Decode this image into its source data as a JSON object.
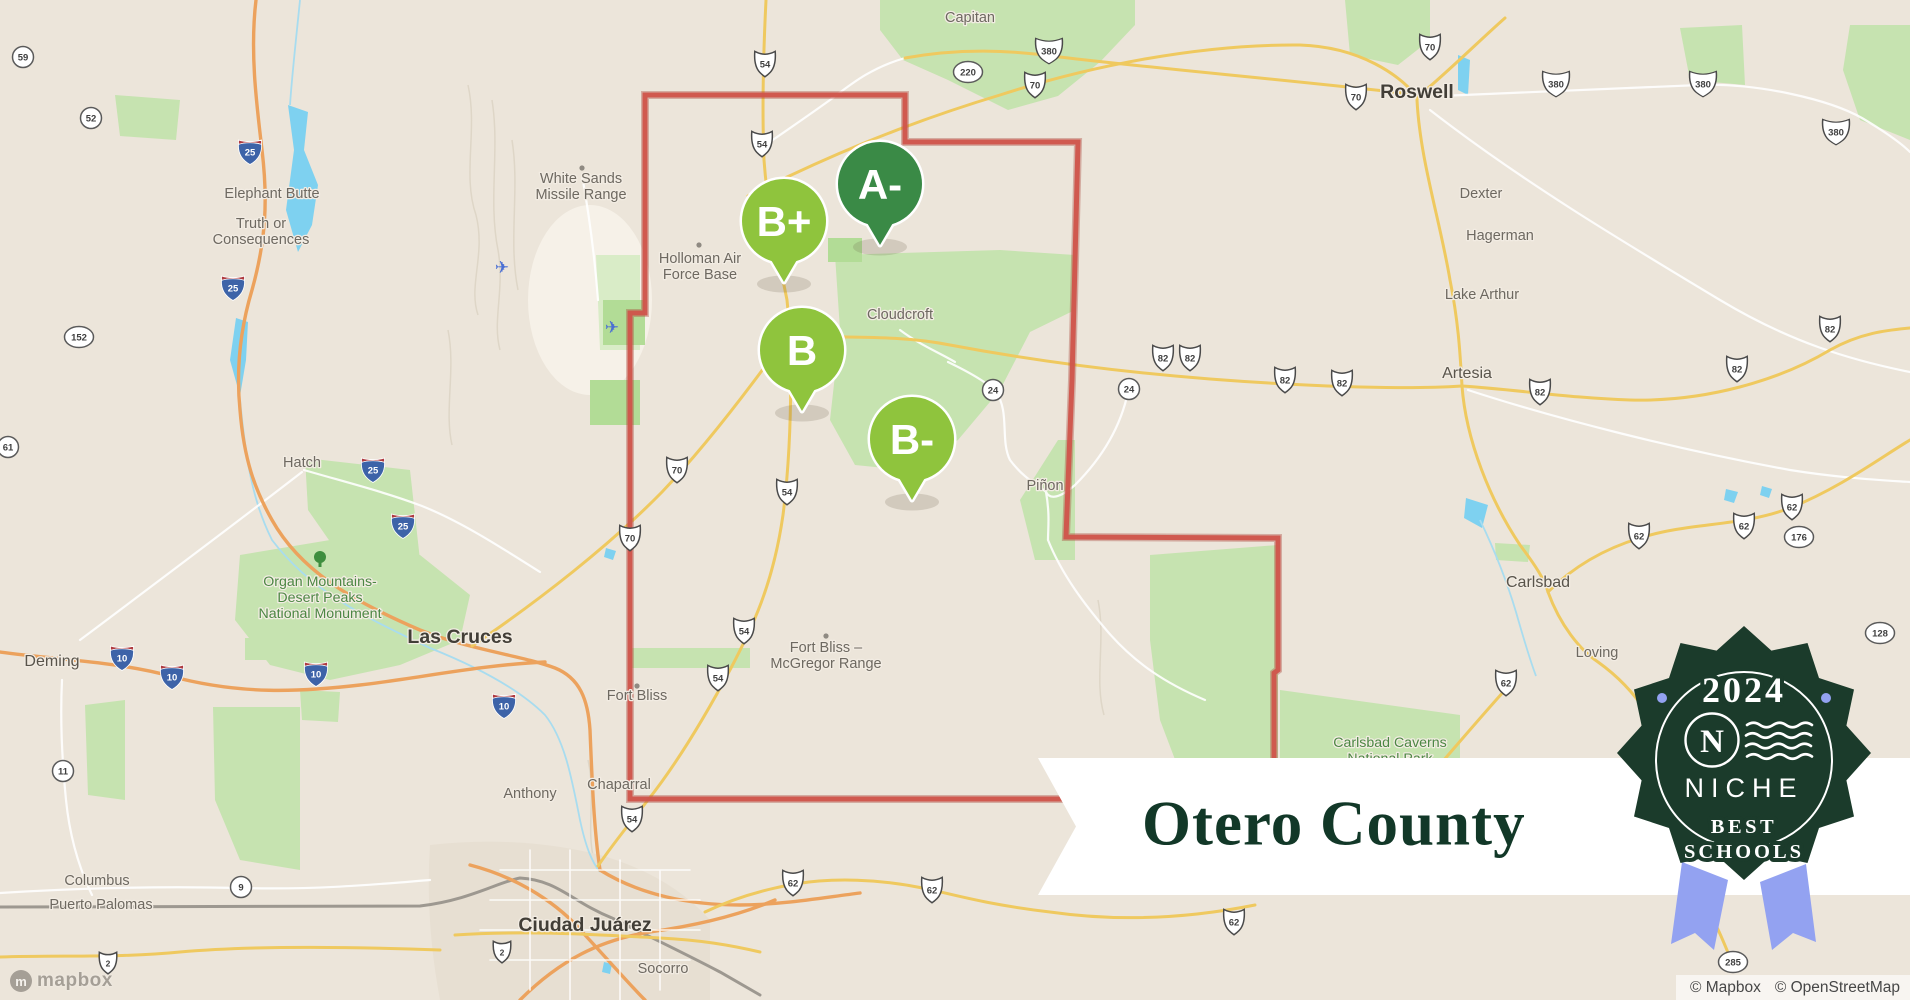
{
  "banner": {
    "title": "Otero County"
  },
  "badge": {
    "year": "2024",
    "logo_letter": "N",
    "brand": "NICHE",
    "tagline_line1": "BEST",
    "tagline_line2": "SCHOOLS",
    "bg_color": "#1b3b2b",
    "ribbon_color": "#93a2f1"
  },
  "attribution": {
    "mapbox": "© Mapbox",
    "osm": "© OpenStreetMap"
  },
  "logo": {
    "text": "mapbox",
    "icon_letter": "m"
  },
  "colors": {
    "land": "#ede6dc",
    "forest": "#c6e3b0",
    "water": "#7ed1f0",
    "county_line": "#d0544b",
    "road_yellow": "#efc95f",
    "road_orange": "#eca25d",
    "marker_a": "#3a8a46",
    "marker_b": "#8fc43d"
  },
  "map": {
    "markers": [
      {
        "grade": "A-",
        "x": 880,
        "y": 184,
        "color": "#3a8a46"
      },
      {
        "grade": "B+",
        "x": 784,
        "y": 221,
        "color": "#8fc43d"
      },
      {
        "grade": "B",
        "x": 802,
        "y": 350,
        "color": "#8fc43d"
      },
      {
        "grade": "B-",
        "x": 912,
        "y": 439,
        "color": "#8fc43d"
      }
    ],
    "towns": [
      {
        "x": 970,
        "y": 22,
        "cls": "",
        "lines": [
          "Capitan"
        ]
      },
      {
        "x": 1417,
        "y": 98,
        "cls": "lg",
        "lines": [
          "Roswell"
        ]
      },
      {
        "x": 272,
        "y": 198,
        "cls": "",
        "lines": [
          "Elephant Butte"
        ]
      },
      {
        "x": 261,
        "y": 228,
        "cls": "",
        "lines": [
          "Truth or",
          "Consequences"
        ]
      },
      {
        "x": 1481,
        "y": 198,
        "cls": "",
        "lines": [
          "Dexter"
        ]
      },
      {
        "x": 1500,
        "y": 240,
        "cls": "",
        "lines": [
          "Hagerman"
        ]
      },
      {
        "x": 1482,
        "y": 299,
        "cls": "",
        "lines": [
          "Lake Arthur"
        ]
      },
      {
        "x": 1467,
        "y": 378,
        "cls": "md",
        "lines": [
          "Artesia"
        ]
      },
      {
        "x": 581,
        "y": 183,
        "cls": "",
        "lines": [
          "White Sands",
          "Missile Range"
        ]
      },
      {
        "x": 700,
        "y": 263,
        "cls": "",
        "lines": [
          "Holloman Air",
          "Force Base"
        ]
      },
      {
        "x": 900,
        "y": 319,
        "cls": "",
        "lines": [
          "Cloudcroft"
        ]
      },
      {
        "x": 302,
        "y": 467,
        "cls": "",
        "lines": [
          "Hatch"
        ]
      },
      {
        "x": 1045,
        "y": 490,
        "cls": "",
        "lines": [
          "Piñon"
        ]
      },
      {
        "x": 460,
        "y": 643,
        "cls": "lg",
        "lines": [
          "Las Cruces"
        ]
      },
      {
        "x": 52,
        "y": 666,
        "cls": "md",
        "lines": [
          "Deming"
        ]
      },
      {
        "x": 826,
        "y": 652,
        "cls": "",
        "lines": [
          "Fort Bliss –",
          "McGregor Range"
        ]
      },
      {
        "x": 637,
        "y": 700,
        "cls": "",
        "lines": [
          "Fort Bliss"
        ]
      },
      {
        "x": 1538,
        "y": 587,
        "cls": "md",
        "lines": [
          "Carlsbad"
        ]
      },
      {
        "x": 1597,
        "y": 657,
        "cls": "",
        "lines": [
          "Loving"
        ]
      },
      {
        "x": 619,
        "y": 789,
        "cls": "",
        "lines": [
          "Chaparral"
        ]
      },
      {
        "x": 530,
        "y": 798,
        "cls": "",
        "lines": [
          "Anthony"
        ]
      },
      {
        "x": 97,
        "y": 885,
        "cls": "",
        "lines": [
          "Columbus"
        ]
      },
      {
        "x": 101,
        "y": 909,
        "cls": "",
        "lines": [
          "Puerto Palomas"
        ]
      },
      {
        "x": 585,
        "y": 931,
        "cls": "lg",
        "lines": [
          "Ciudad Juárez"
        ]
      },
      {
        "x": 663,
        "y": 973,
        "cls": "",
        "lines": [
          "Socorro"
        ]
      },
      {
        "x": 320,
        "y": 586,
        "cls": "area",
        "lines": [
          "Organ Mountains-",
          "Desert Peaks",
          "National Monument"
        ]
      },
      {
        "x": 1390,
        "y": 747,
        "cls": "area",
        "lines": [
          "Carlsbad Caverns",
          "National Park"
        ]
      }
    ],
    "shields": [
      {
        "num": "54",
        "type": "us",
        "x": 765,
        "y": 64
      },
      {
        "num": "54",
        "type": "us",
        "x": 762,
        "y": 144
      },
      {
        "num": "380",
        "type": "us3",
        "x": 1049,
        "y": 51
      },
      {
        "num": "220",
        "type": "o",
        "x": 968,
        "y": 72
      },
      {
        "num": "70",
        "type": "us",
        "x": 1035,
        "y": 85
      },
      {
        "num": "70",
        "type": "us",
        "x": 1430,
        "y": 47
      },
      {
        "num": "70",
        "type": "us",
        "x": 1356,
        "y": 97
      },
      {
        "num": "380",
        "type": "us3",
        "x": 1556,
        "y": 84
      },
      {
        "num": "380",
        "type": "us3",
        "x": 1703,
        "y": 84
      },
      {
        "num": "380",
        "type": "us3",
        "x": 1836,
        "y": 132
      },
      {
        "num": "59",
        "type": "c",
        "x": 23,
        "y": 57
      },
      {
        "num": "52",
        "type": "c",
        "x": 91,
        "y": 118
      },
      {
        "num": "25",
        "type": "i",
        "x": 250,
        "y": 152
      },
      {
        "num": "25",
        "type": "i",
        "x": 233,
        "y": 288
      },
      {
        "num": "152",
        "type": "o",
        "x": 79,
        "y": 337
      },
      {
        "num": "61",
        "type": "c",
        "x": 8,
        "y": 447
      },
      {
        "num": "25",
        "type": "i",
        "x": 373,
        "y": 470
      },
      {
        "num": "25",
        "type": "i",
        "x": 403,
        "y": 526
      },
      {
        "num": "70",
        "type": "us",
        "x": 677,
        "y": 470
      },
      {
        "num": "70",
        "type": "us",
        "x": 630,
        "y": 538
      },
      {
        "num": "54",
        "type": "us",
        "x": 787,
        "y": 492
      },
      {
        "num": "54",
        "type": "us",
        "x": 744,
        "y": 631
      },
      {
        "num": "54",
        "type": "us",
        "x": 718,
        "y": 678
      },
      {
        "num": "54",
        "type": "us",
        "x": 632,
        "y": 819
      },
      {
        "num": "24",
        "type": "c",
        "x": 993,
        "y": 390
      },
      {
        "num": "24",
        "type": "c",
        "x": 1129,
        "y": 389
      },
      {
        "num": "82",
        "type": "us",
        "x": 1163,
        "y": 358
      },
      {
        "num": "82",
        "type": "us",
        "x": 1190,
        "y": 358
      },
      {
        "num": "82",
        "type": "us",
        "x": 1285,
        "y": 380
      },
      {
        "num": "82",
        "type": "us",
        "x": 1342,
        "y": 383
      },
      {
        "num": "82",
        "type": "us",
        "x": 1540,
        "y": 392
      },
      {
        "num": "82",
        "type": "us",
        "x": 1737,
        "y": 369
      },
      {
        "num": "82",
        "type": "us",
        "x": 1830,
        "y": 329
      },
      {
        "num": "10",
        "type": "i",
        "x": 122,
        "y": 658
      },
      {
        "num": "10",
        "type": "i",
        "x": 172,
        "y": 677
      },
      {
        "num": "10",
        "type": "i",
        "x": 316,
        "y": 674
      },
      {
        "num": "10",
        "type": "i",
        "x": 504,
        "y": 706
      },
      {
        "num": "62",
        "type": "us",
        "x": 1639,
        "y": 536
      },
      {
        "num": "62",
        "type": "us",
        "x": 1744,
        "y": 526
      },
      {
        "num": "62",
        "type": "us",
        "x": 1792,
        "y": 507
      },
      {
        "num": "176",
        "type": "o",
        "x": 1799,
        "y": 537
      },
      {
        "num": "128",
        "type": "o",
        "x": 1880,
        "y": 633
      },
      {
        "num": "62",
        "type": "us",
        "x": 1506,
        "y": 683
      },
      {
        "num": "11",
        "type": "c",
        "x": 63,
        "y": 771
      },
      {
        "num": "9",
        "type": "c",
        "x": 241,
        "y": 887
      },
      {
        "num": "2",
        "type": "mx",
        "x": 108,
        "y": 963
      },
      {
        "num": "2",
        "type": "mx",
        "x": 502,
        "y": 952
      },
      {
        "num": "62",
        "type": "us",
        "x": 793,
        "y": 883
      },
      {
        "num": "62",
        "type": "us",
        "x": 932,
        "y": 890
      },
      {
        "num": "62",
        "type": "us",
        "x": 1234,
        "y": 922
      },
      {
        "num": "285",
        "type": "o",
        "x": 1733,
        "y": 962
      }
    ],
    "pois": [
      {
        "type": "dot",
        "x": 582,
        "y": 168
      },
      {
        "type": "dot",
        "x": 699,
        "y": 245
      },
      {
        "type": "dot",
        "x": 826,
        "y": 636
      },
      {
        "type": "dot",
        "x": 637,
        "y": 686
      },
      {
        "type": "plane",
        "x": 612,
        "y": 327
      },
      {
        "type": "plane",
        "x": 502,
        "y": 267
      },
      {
        "type": "tree",
        "x": 320,
        "y": 560
      }
    ]
  }
}
